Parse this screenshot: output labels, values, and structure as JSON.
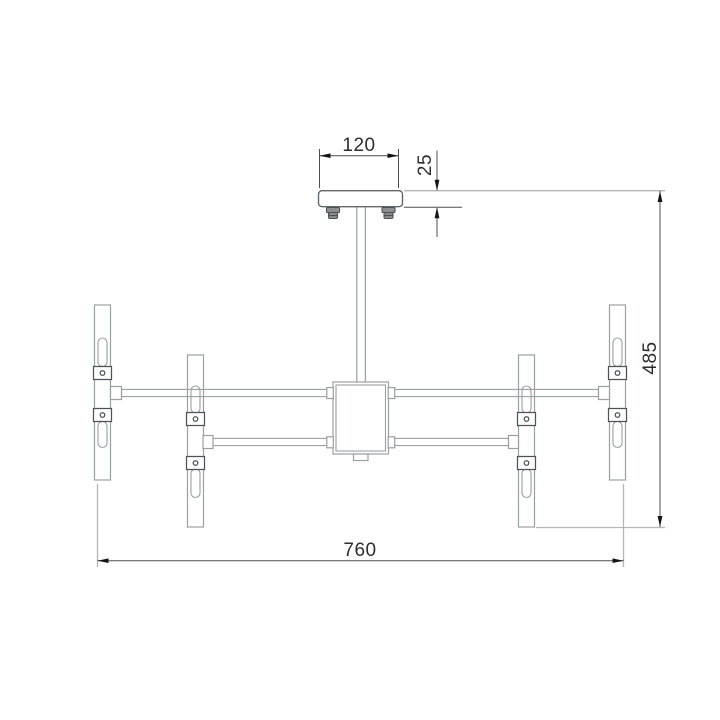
{
  "drawing": {
    "dimension_labels": {
      "canopy_width": "120",
      "canopy_height": "25",
      "fixture_height": "485",
      "fixture_width": "760"
    },
    "colors": {
      "background": "#ffffff",
      "body_outline": "#9aa0a0",
      "canopy_outline": "#61666a",
      "hardware_outline": "#4e5254",
      "dimension_line": "#4f4f4f",
      "extension_line": "#b3b7b7",
      "arrow_color": "#141414",
      "dimension_text": "#2d2d2d"
    }
  }
}
